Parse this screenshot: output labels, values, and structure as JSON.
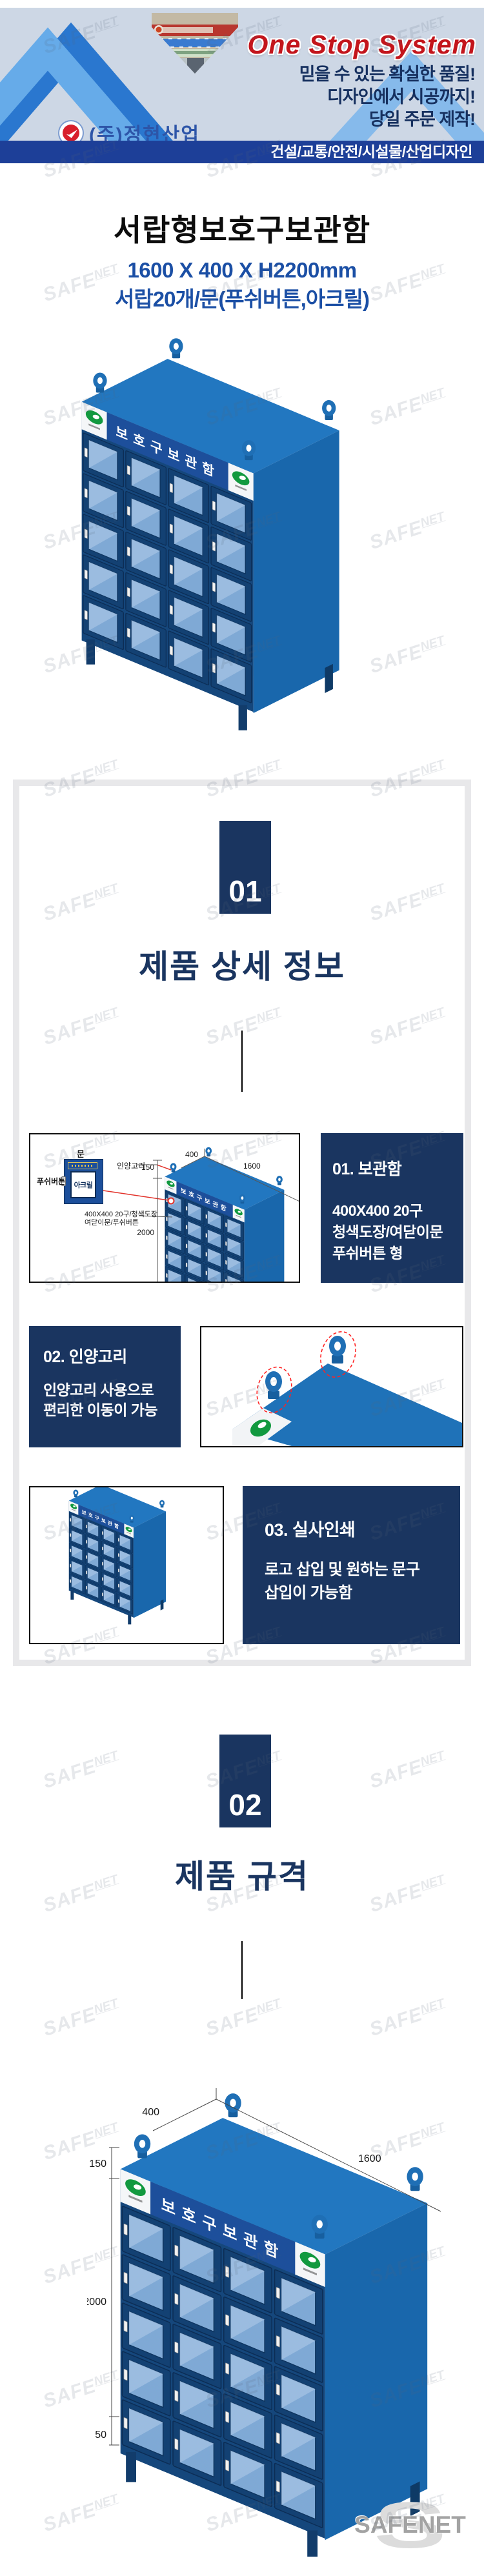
{
  "banner": {
    "headline": "One Stop System",
    "taglines": [
      "믿을 수 있는 확실한 품질!",
      "디자인에서 시공까지!",
      "당일 주문 제작!"
    ],
    "company": "(주)정현산업",
    "category_bar": "건설/교통/안전/시설물/산업디자인"
  },
  "product": {
    "title": "서랍형보호구보관함",
    "size": "1600 X 400 X H2200mm",
    "spec": "서랍20개/문(푸쉬버튼,아크릴)",
    "board_label": "보호구보관함"
  },
  "section1": {
    "number": "01",
    "title": "제품 상세 정보",
    "diagram": {
      "door_label": "문",
      "acrylic_label": "아크릴",
      "push_button_label": "푸쉬버튼",
      "hook_label": "인양고리",
      "dim_150": "150",
      "dim_2000": "2000",
      "dim_400": "400",
      "dim_1600": "1600",
      "drawer_note_line1": "400X400 20구/청색도장",
      "drawer_note_line2": "여닫이문/푸쉬버튼"
    },
    "cards": [
      {
        "title": "01. 보관함",
        "lines": [
          "400X400 20구",
          "청색도장/여닫이문",
          "푸쉬버튼 형"
        ]
      },
      {
        "title": "02. 인양고리",
        "lines": [
          "인양고리 사용으로",
          "편리한 이동이 가능",
          ""
        ]
      },
      {
        "title": "03. 실사인쇄",
        "lines": [
          "로고 삽입 및 원하는 문구",
          "삽입이 가능함",
          ""
        ]
      }
    ]
  },
  "section2": {
    "number": "02",
    "title": "제품 규격",
    "dims": {
      "width_top": "400",
      "length_top": "1600",
      "header_h": "150",
      "body_h": "2000",
      "leg_h": "50"
    }
  },
  "watermark": {
    "part1": "SAFE",
    "part2": "NET"
  },
  "footer_logo": {
    "monogram": "S",
    "text": "SAFENET"
  },
  "colors": {
    "navy": "#1a3560",
    "bar_blue": "#1d3f98",
    "headline_red": "#c3151c",
    "subtitle_blue": "#1b4fa5",
    "cabinet_blue": "#1f6fb5",
    "callout_red": "#e2322a",
    "frame_gray": "#e8e8ea"
  }
}
